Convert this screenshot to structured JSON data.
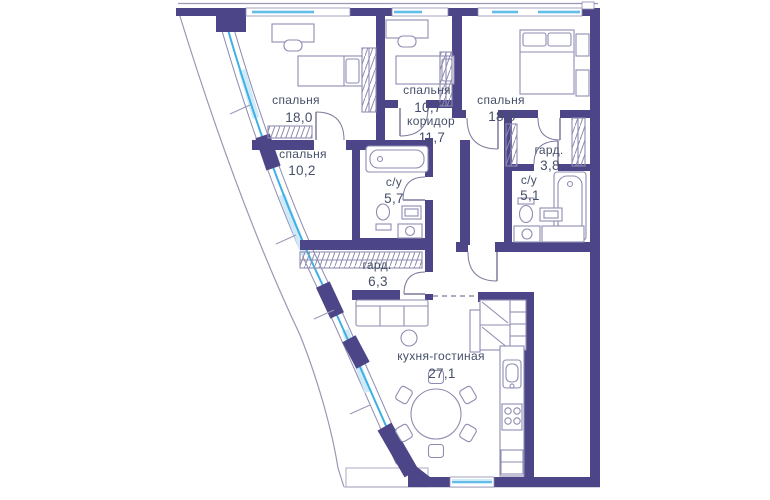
{
  "rooms": [
    {
      "id": "bedroom-1",
      "name": "спальня",
      "area": "18,0"
    },
    {
      "id": "bedroom-2",
      "name": "спальня",
      "area": "10,7"
    },
    {
      "id": "bedroom-3",
      "name": "спальня",
      "area": "18,0"
    },
    {
      "id": "corridor",
      "name": "коридор",
      "area": "11,7"
    },
    {
      "id": "bedroom-4",
      "name": "спальня",
      "area": "10,2"
    },
    {
      "id": "bathroom-1",
      "name": "с/у",
      "area": "5,7"
    },
    {
      "id": "wardrobe-1",
      "name": "гард.",
      "area": "3,8"
    },
    {
      "id": "bathroom-2",
      "name": "с/у",
      "area": "5,1"
    },
    {
      "id": "wardrobe-2",
      "name": "гард.",
      "area": "6,3"
    },
    {
      "id": "kitchen-living",
      "name": "кухня-гостиная",
      "area": "27,1"
    }
  ],
  "colors": {
    "wall": "#4c4587",
    "glass_line": "#3fb0e3",
    "glass_pane": "#cfeaf8",
    "outline": "#8e8cb0",
    "text": "#454f68",
    "background": "#ffffff"
  }
}
